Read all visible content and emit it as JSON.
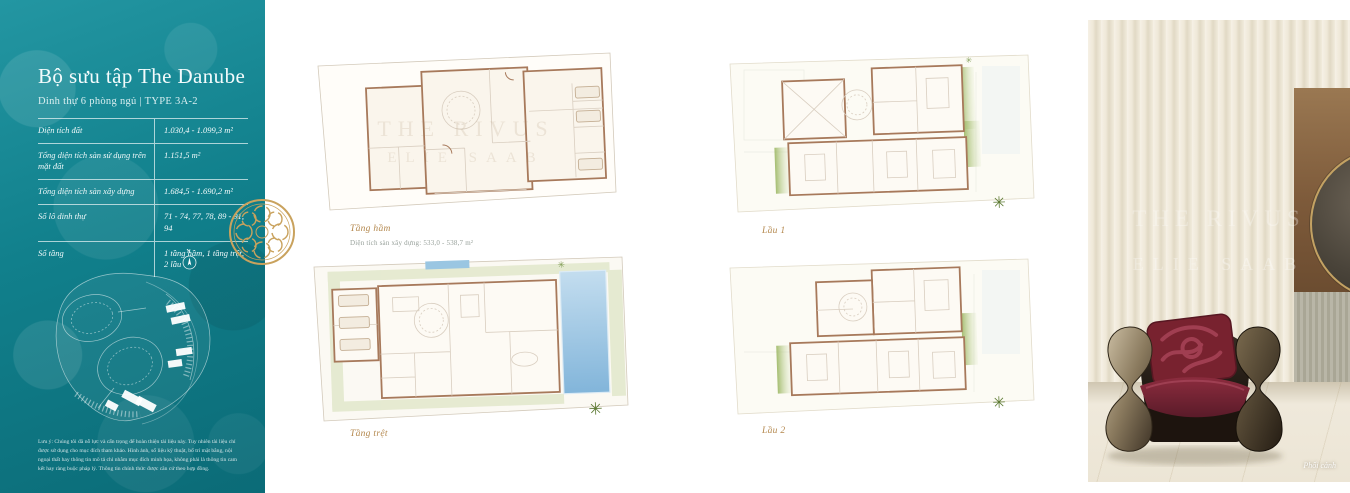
{
  "sidebar": {
    "title": "Bộ sưu tập The Danube",
    "subtitle": "Dinh thự 6 phòng ngủ | TYPE 3A-2",
    "specs": [
      {
        "label": "Diện tích đất",
        "value": "1.030,4 - 1.099,3 m²"
      },
      {
        "label": "Tổng diện tích sàn sử dụng trên mặt đất",
        "value": "1.151,5 m²"
      },
      {
        "label": "Tổng diện tích sàn xây dựng",
        "value": "1.684,5 - 1.690,2 m²"
      },
      {
        "label": "Số lô dinh thự",
        "value": "71 - 74, 77, 78, 89 - 91, 94"
      },
      {
        "label": "Số tầng",
        "value": "1 tầng hầm, 1 tầng trệt, 2 lầu"
      }
    ],
    "compass_n": "N",
    "disclaimer": "Lưu ý: Chúng tôi đã nỗ lực và cẩn trọng để hoàn thiện tài liệu này. Tuy nhiên tài liệu chỉ được sử dụng cho mục đích tham khảo. Hình ảnh, số liệu kỹ thuật, bố trí mặt bằng, nội ngoại thất hay thông tin mô tả chỉ nhằm mục đích minh họa, không phải là thông tin cam kết hay ràng buộc pháp lý. Thông tin chính thức được căn cứ theo hợp đồng."
  },
  "plans": [
    {
      "caption": "Tầng hầm",
      "subcaption": "Diện tích sàn xây dựng: 533,0 - 538,7 m²"
    },
    {
      "caption": "Tầng trệt",
      "subcaption": ""
    },
    {
      "caption": "Lầu 1",
      "subcaption": ""
    },
    {
      "caption": "Lầu 2",
      "subcaption": ""
    }
  ],
  "watermarks": {
    "line1": "THE RIVUS",
    "line2": "ELIE SAAB"
  },
  "photo": {
    "caption": "Phối cảnh"
  },
  "colors": {
    "teal": "#11808c",
    "gold": "#c9a25d",
    "caption_gold": "#b4884e",
    "wall_brown": "#a7795b",
    "pool_blue": "#8fc0e0",
    "landscape_green": "#ccd8a8",
    "burgundy": "#6d2130"
  }
}
